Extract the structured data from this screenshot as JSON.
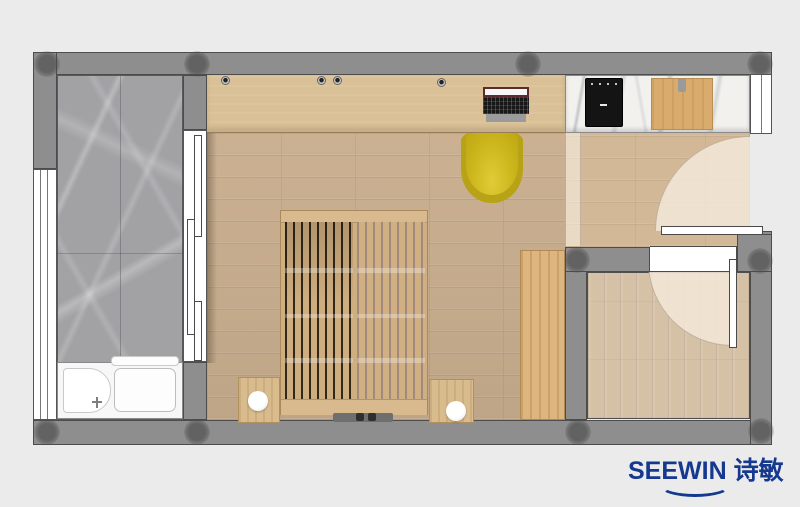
{
  "brand": {
    "latin": "SEEWIN",
    "cjk": "诗敏"
  },
  "colors": {
    "background": "#ebebeb",
    "wall": "#8e8e8e",
    "wall_outline": "#4c4c4c",
    "column": "#4b4b4b",
    "balcony_marble": "#a2a2a5",
    "bedroom_floor": "#c9ae8e",
    "corridor_floor": "#d2b897",
    "second_room_floor": "#d5c2a6",
    "desk_wood": "#dac096",
    "cabinet_wood": "#ddb57f",
    "bed_wood": "#cfae80",
    "bed_slat_gap_dark": "#33261a",
    "bed_slat_gap_light": "#a18a7c",
    "chair_yellow": "#c9b120",
    "counter_marble": "#f2f1ee",
    "cooktop_black": "#141414",
    "cutting_board": "#d9ab6d",
    "door_leaf_white": "#ffffff",
    "door_swing_overlay": "#f3e8d8",
    "bathtub_white": "#f7f7f7",
    "logo_blue": "#15398f"
  }
}
